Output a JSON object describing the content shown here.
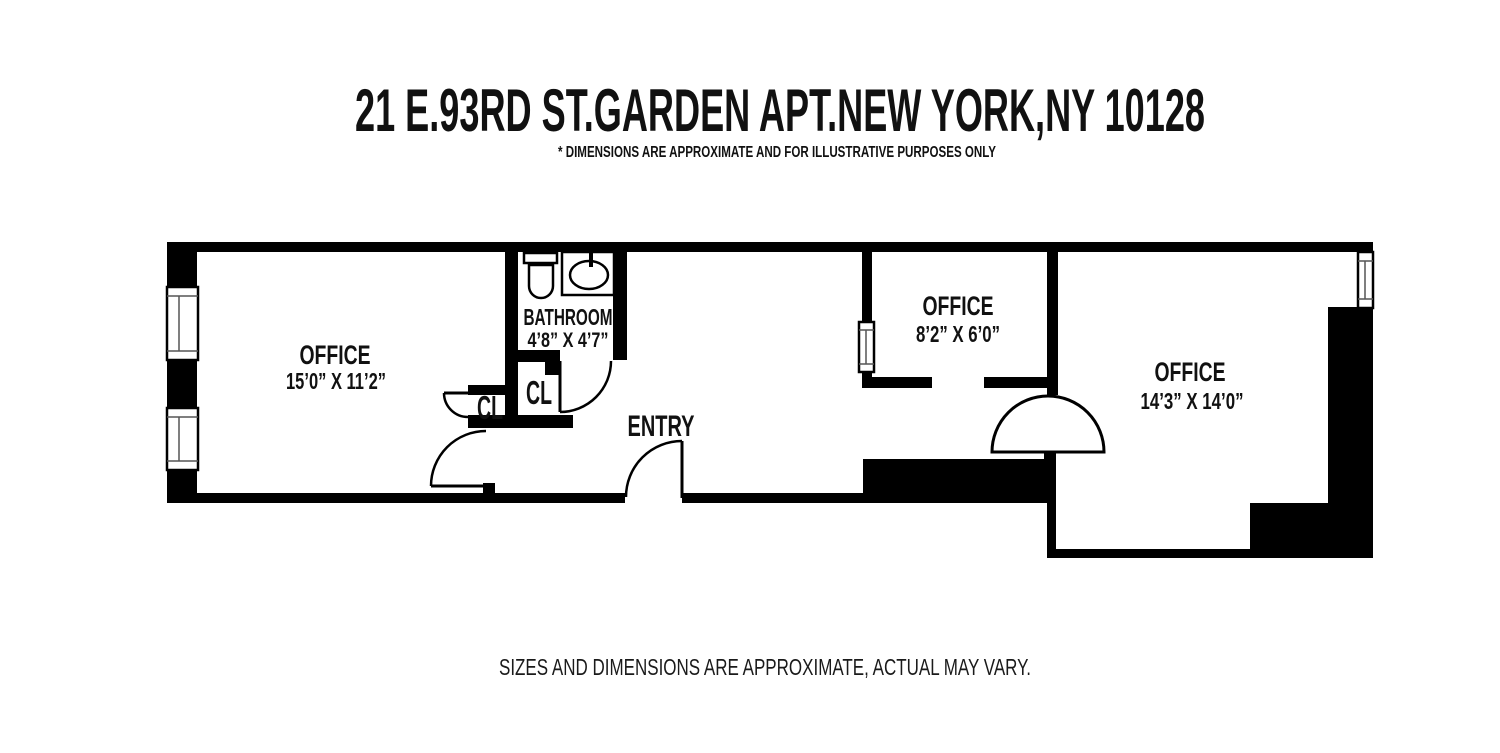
{
  "page": {
    "title": "21 E.93RD ST.GARDEN APT.NEW YORK,NY 10128",
    "disclaimer": "* DIMENSIONS ARE APPROXIMATE AND FOR ILLUSTRATIVE PURPOSES ONLY",
    "footer": "SIZES AND DIMENSIONS ARE APPROXIMATE, ACTUAL MAY VARY."
  },
  "floorplan": {
    "colors": {
      "walls": "#000000",
      "background": "#ffffff",
      "text": "#111111"
    },
    "rooms": {
      "office_left": {
        "label": "OFFICE",
        "dims": "15’0” X 11’2”"
      },
      "bathroom": {
        "label": "BATHROOM",
        "dims": "4’8” X 4’7”"
      },
      "closet_left": {
        "label": "CL"
      },
      "closet_mid": {
        "label": "CL"
      },
      "entry": {
        "label": "ENTRY"
      },
      "office_mid": {
        "label": "OFFICE",
        "dims": "8’2” X 6’0”"
      },
      "office_right": {
        "label": "OFFICE",
        "dims": "14’3” X 14’0”"
      }
    },
    "fixtures": [
      "toilet",
      "sink"
    ]
  }
}
